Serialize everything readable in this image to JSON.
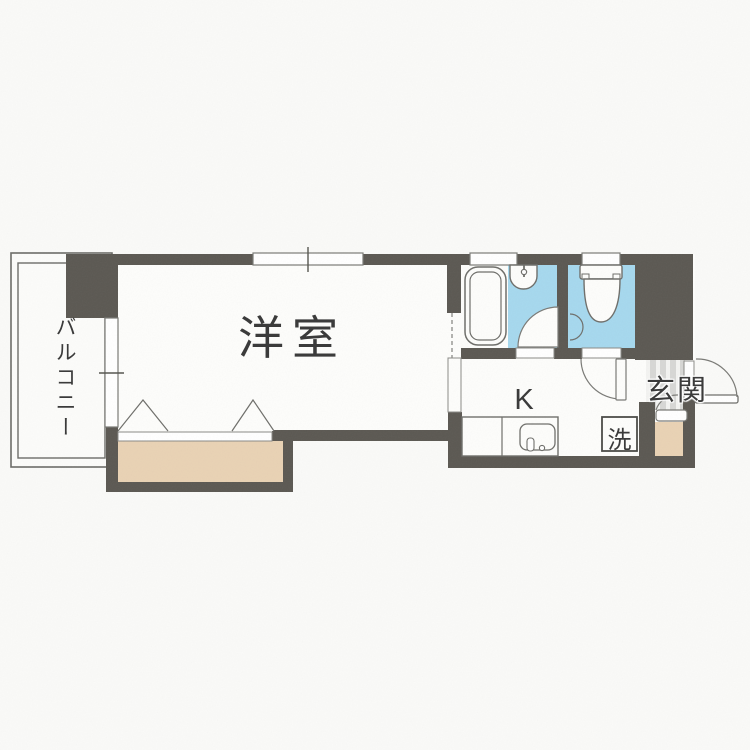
{
  "document": {
    "type": "apartment-floor-plan",
    "style": "Japanese 1K layout drawing"
  },
  "labels": {
    "balcony": "バルコニー",
    "western_room": "洋室",
    "kitchen": "K",
    "entrance": "玄関",
    "laundry": "洗"
  },
  "colors": {
    "background": "#fafaf8",
    "wall": "#5b5852",
    "wet_area_floor": "#a6d8ee",
    "closet_floor": "#e9d2b4",
    "entrance_tile": "#d7d7d5",
    "fixture_line": "#6e6e6a",
    "text": "#3b3b3b"
  },
  "fixtures": {
    "bathtub": "bathtub",
    "bathroom_hand_basin": "hand-basin",
    "toilet": "toilet-with-tank",
    "kitchen_counter": "kitchen-counter-with-sink",
    "washing_machine_space": "washing-machine-space",
    "closet": "closet-with-folding-doors",
    "front_door": "outward-swing-door",
    "room_window": "sliding-window",
    "balcony_window": "sliding-window",
    "bath_window": "small-window",
    "toilet_window": "small-window"
  }
}
